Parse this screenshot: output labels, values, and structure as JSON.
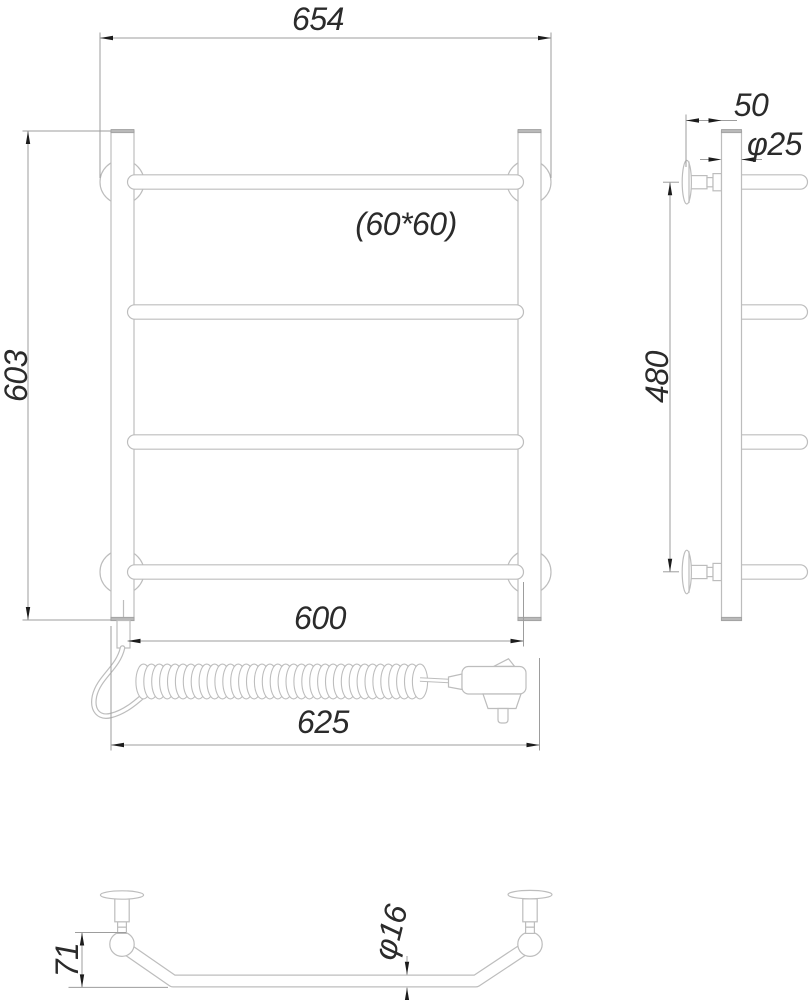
{
  "dimensions": {
    "front": {
      "overall_width": "654",
      "bar_section": "(60*60)",
      "overall_height": "603",
      "bar_length": "600",
      "mounting_width": "625"
    },
    "side": {
      "bracket_depth": "50",
      "post_diameter": "φ25",
      "bracket_span": "480"
    },
    "bottom": {
      "bracket_height": "71",
      "tube_diameter": "φ16"
    }
  },
  "colors": {
    "artwork_line": "#bdbdbd",
    "dimension_line": "#9d9d9d",
    "arrowhead": "#1c1c1c",
    "text": "#2b2b2b",
    "end_cap_fill": "#b9b9b9",
    "background": "#ffffff"
  }
}
